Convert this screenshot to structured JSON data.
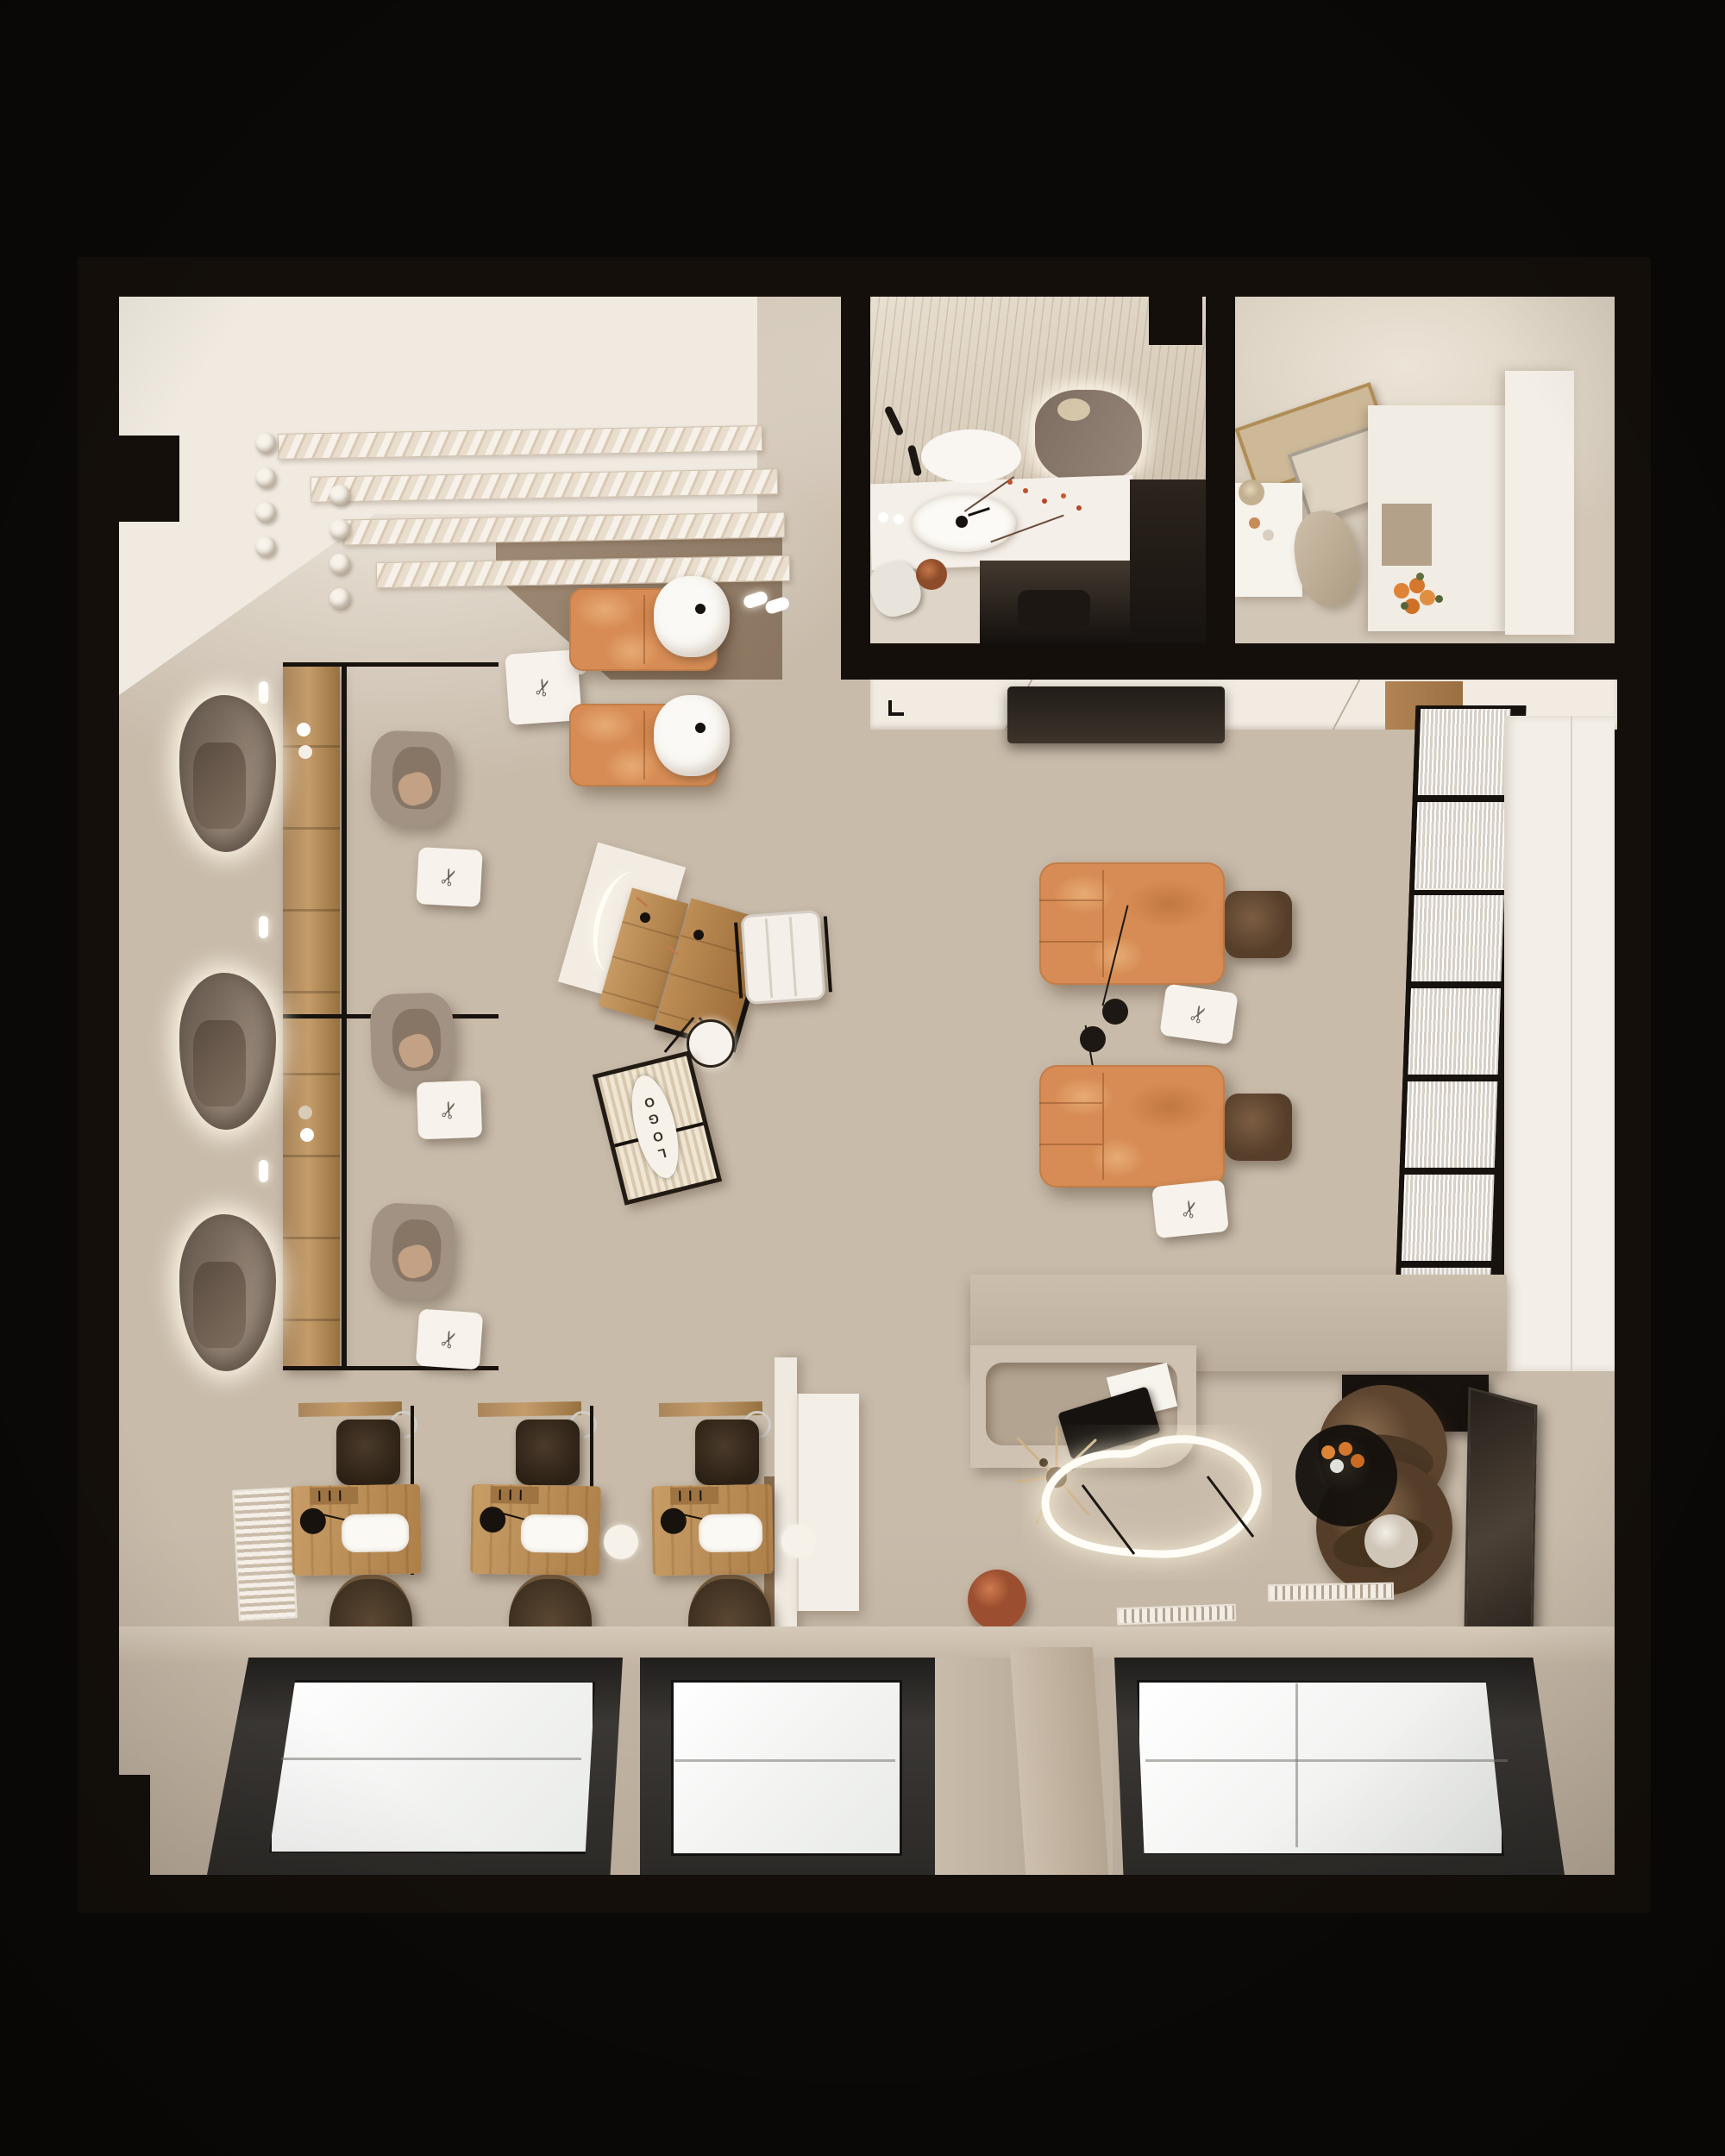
{
  "scene": {
    "description": "Top-down 3D render of a beauty salon floor plan",
    "logo_text": "LOGO"
  },
  "palette": {
    "bg": "#0b0907",
    "wall": "#140f0a",
    "floor": "#c8bbaa",
    "floor-light": "#e9e2d7",
    "floor-deep": "#b3a390",
    "white": "#f0eae1",
    "white-soft": "#e7e0d5",
    "wood": "#b88a58",
    "wood-dark": "#8a6438",
    "wood-light": "#cda06c",
    "orange": "#d68c54",
    "orange-light": "#e7ab74",
    "orange-deep": "#c17841",
    "taupe": "#a29283",
    "taupe-deep": "#877666",
    "brown-dark": "#4e3c2b",
    "brown-mid": "#6f573f",
    "charcoal": "#2e2b28",
    "glass": "#fbfaf8",
    "glow": "#fff6e6",
    "terracotta": "#b5663f",
    "fruit-orange": "#dd8436",
    "black": "#17120d"
  }
}
